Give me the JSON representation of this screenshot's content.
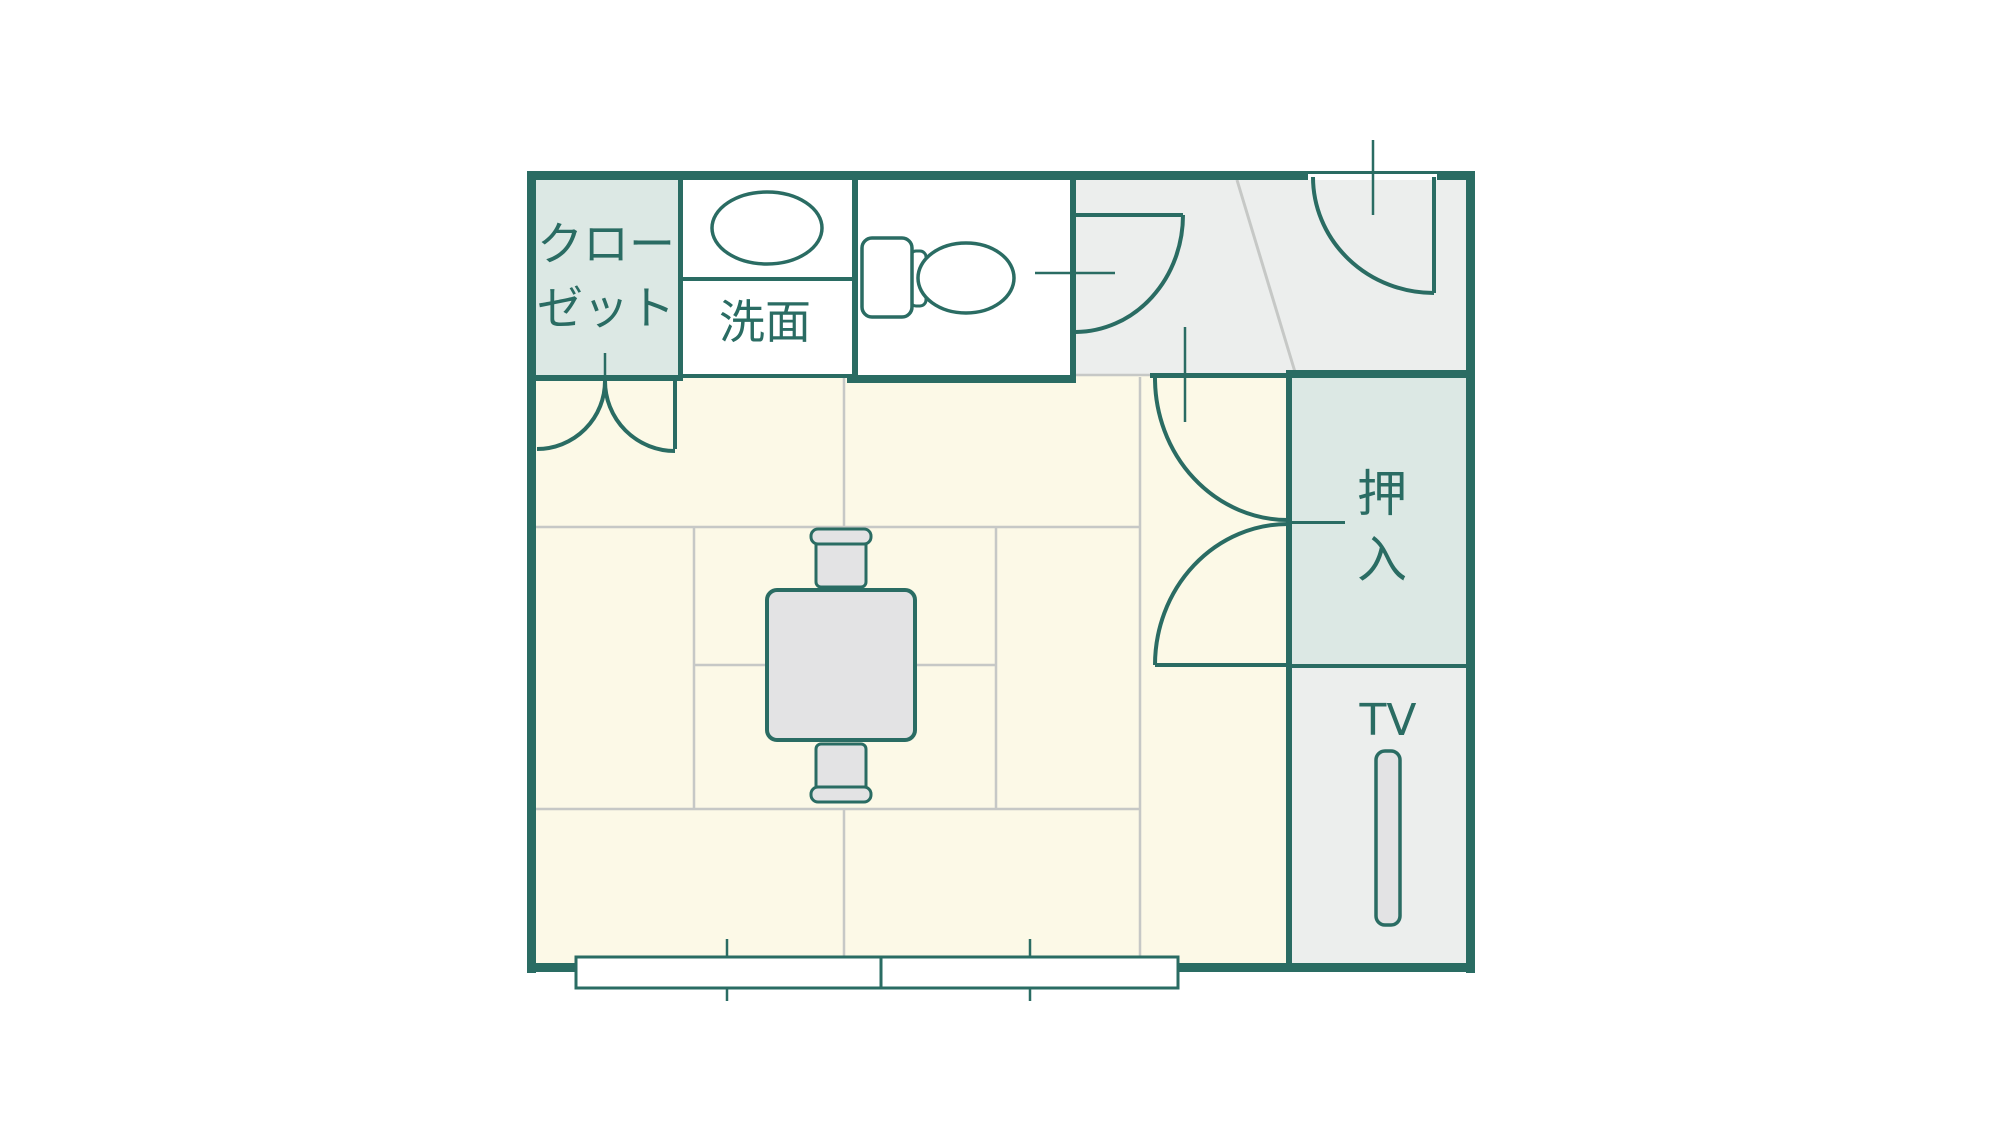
{
  "floorplan": {
    "title": "room-floor-plan",
    "rooms": {
      "closet": {
        "name": "closet",
        "label": [
          "クロー",
          "ゼット"
        ]
      },
      "washstand": {
        "name": "washstand",
        "label": "洗面"
      },
      "toilet": {
        "name": "toilet-room",
        "label": ""
      },
      "entry": {
        "name": "entry-genkan",
        "label": ""
      },
      "oshiire": {
        "name": "oshiire-closet",
        "label_chars": [
          "押",
          "入"
        ]
      },
      "tv_area": {
        "name": "tv-area",
        "label": "TV"
      },
      "tatami": {
        "name": "tatami-room",
        "label": ""
      }
    },
    "fixtures": [
      "sink-icon",
      "toilet-icon",
      "low-table",
      "chair",
      "chair",
      "tv-unit",
      "window",
      "window"
    ],
    "doors": [
      "closet-double-door",
      "toilet-door",
      "entry-door",
      "oshiire-double-door"
    ],
    "colors": {
      "wall_teal": "#2a6c63",
      "tatami_cream": "#fcf9e7",
      "closet_fill": "#dce8e4",
      "entry_gray": "#eceeed",
      "furniture_gray": "#e3e3e4",
      "grid_gray": "#c6c8c6",
      "background": "#ffffff",
      "fixture_white": "#ffffff"
    }
  }
}
